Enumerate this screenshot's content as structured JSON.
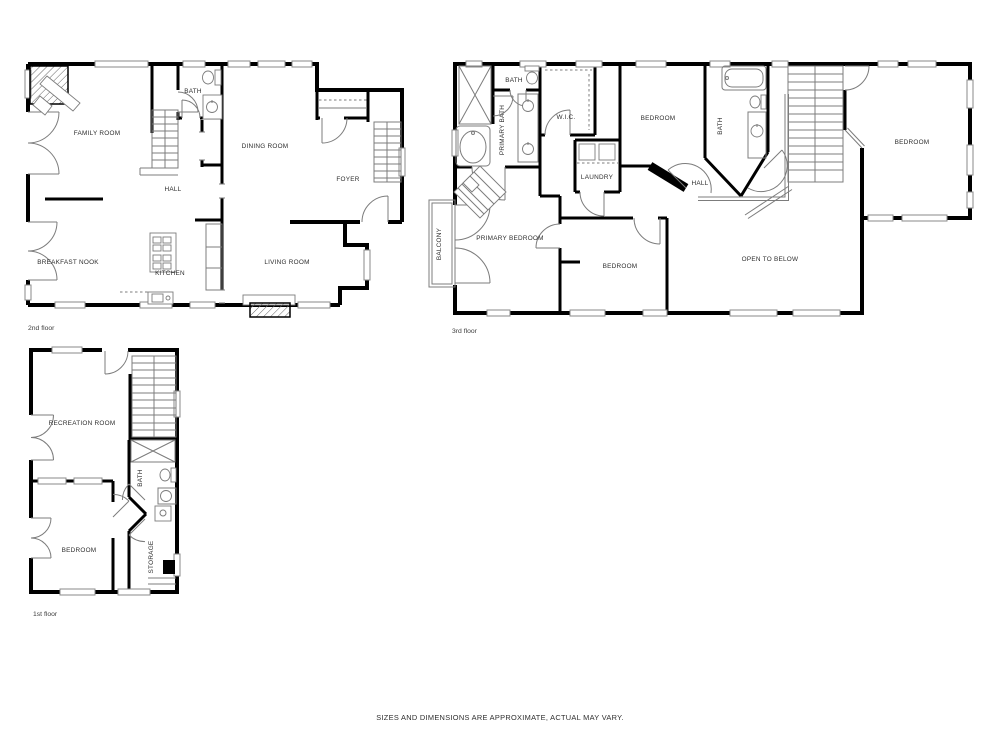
{
  "disclaimer": "SIZES AND DIMENSIONS ARE APPROXIMATE, ACTUAL MAY VARY.",
  "colors": {
    "walls": "#000000",
    "fixtures": "#7c7c7c",
    "labels": "#2e2e2e",
    "background": "#ffffff"
  },
  "floors": {
    "second": {
      "label": "2nd floor",
      "rooms": {
        "family_room": "FAMILY ROOM",
        "bath": "BATH",
        "dining_room": "DINING ROOM",
        "foyer": "FOYER",
        "hall": "HALL",
        "breakfast_nook": "BREAKFAST NOOK",
        "kitchen": "KITCHEN",
        "living_room": "LIVING ROOM"
      }
    },
    "third": {
      "label": "3rd floor",
      "rooms": {
        "bath_top": "BATH",
        "primary_bath": "PRIMARY BATH",
        "wic": "W.I.C.",
        "bedroom_top": "BEDROOM",
        "bath_right": "BATH",
        "laundry": "LAUNDRY",
        "hall": "HALL",
        "balcony": "BALCONY",
        "primary_bedroom": "PRIMARY BEDROOM",
        "bedroom_bottom": "BEDROOM",
        "bedroom_right": "BEDROOM",
        "open_to_below": "OPEN TO BELOW"
      }
    },
    "first": {
      "label": "1st floor",
      "rooms": {
        "recreation_room": "RECREATION ROOM",
        "bath": "BATH",
        "bedroom": "BEDROOM",
        "storage": "STORAGE"
      }
    }
  }
}
